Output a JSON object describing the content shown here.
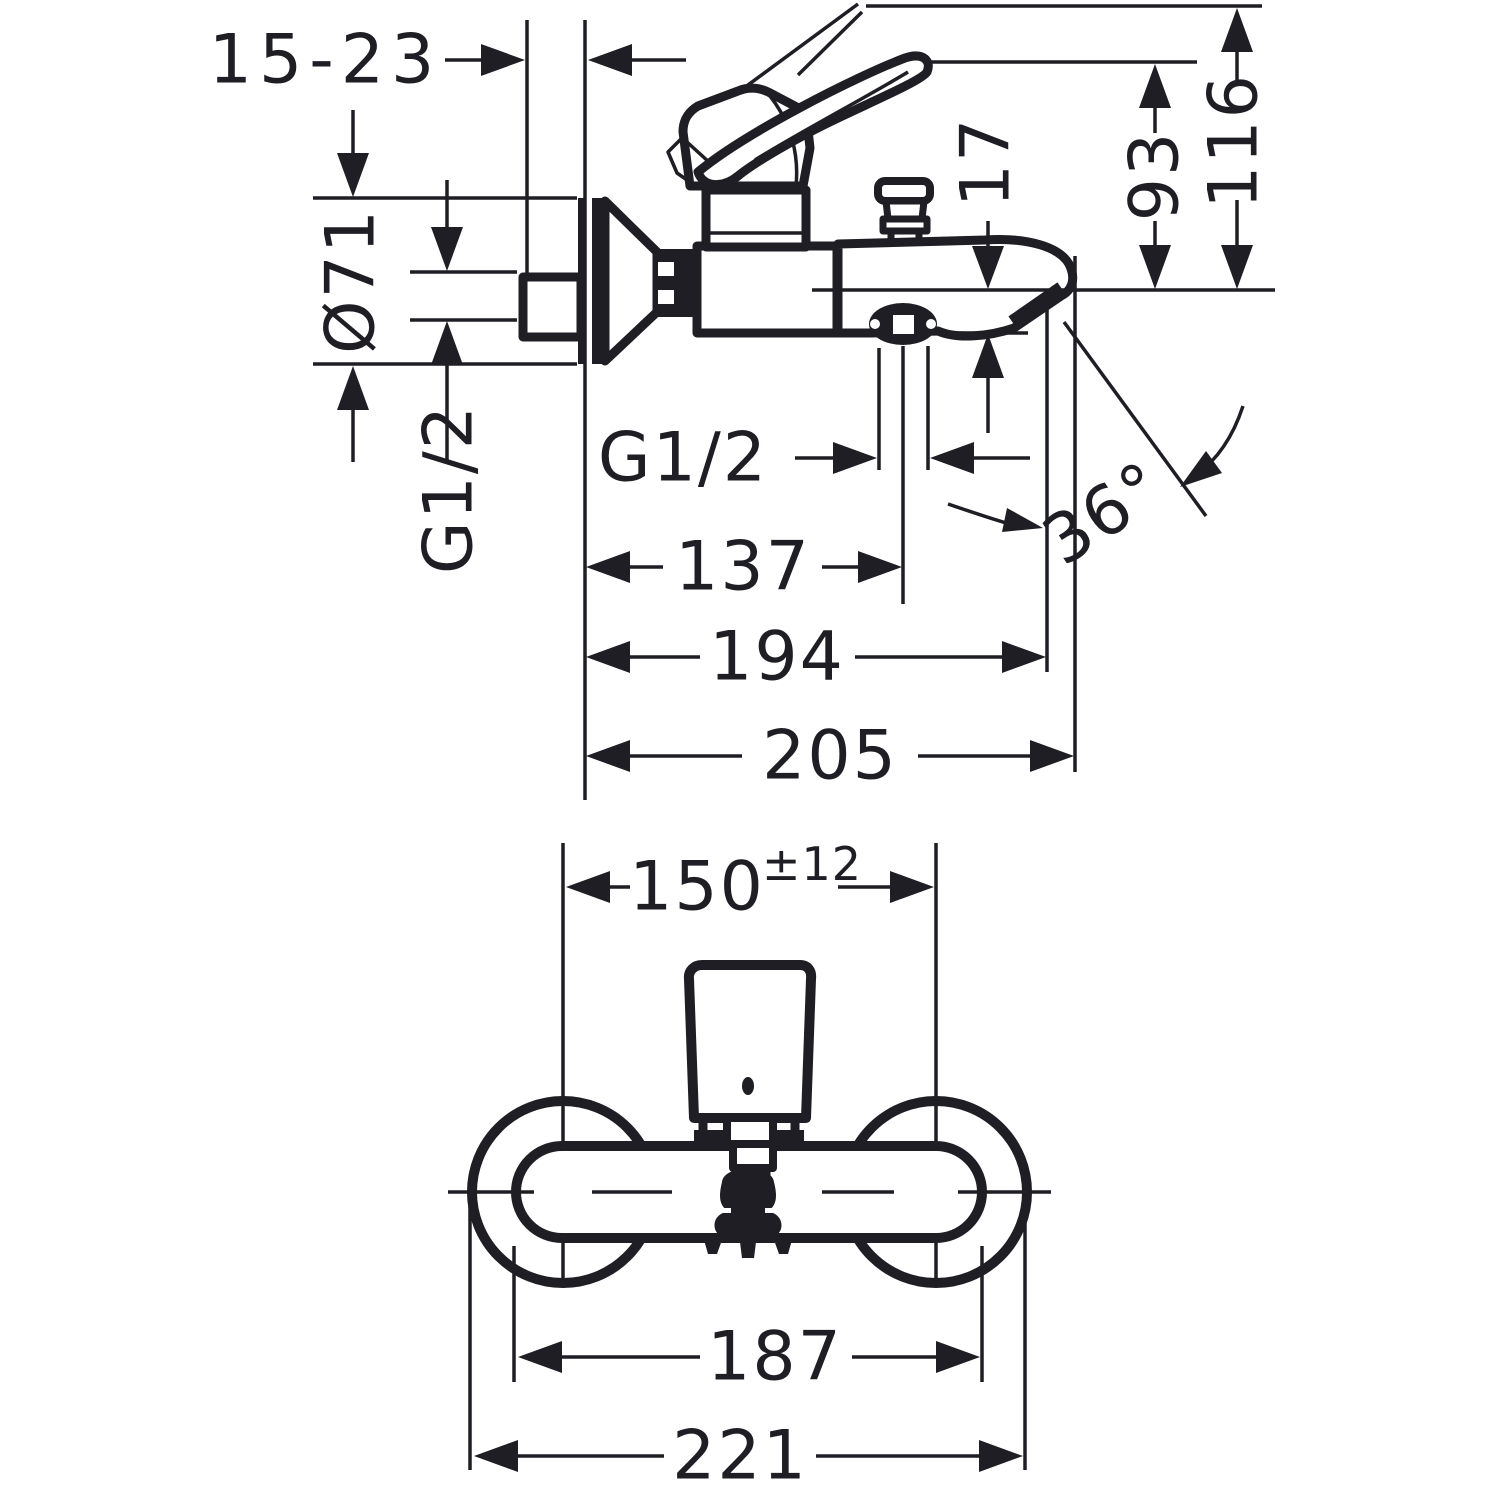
{
  "colors": {
    "ink": "#1e1e24",
    "paper": "#ffffff"
  },
  "drawing": {
    "type": "technical-dimension-drawing",
    "product": "wall-mounted single-lever bath mixer",
    "side": {
      "label": "side view",
      "wall_distance": "15-23",
      "escutcheon_diameter": "Ø71",
      "wall_connection_thread": "G1/2",
      "spout_lip_drop": "17",
      "height_spout_to_lever": "93",
      "height_spout_to_lever_raised": "116",
      "shower_outlet_thread": "G1/2",
      "spout_angle": "36°",
      "outlet_center_reach": "137",
      "spout_reach": "194",
      "overall_reach": "205"
    },
    "front": {
      "label": "front view",
      "connection_centers": "150",
      "connection_centers_tolerance": "±12",
      "body_width": "187",
      "overall_width": "221"
    }
  }
}
